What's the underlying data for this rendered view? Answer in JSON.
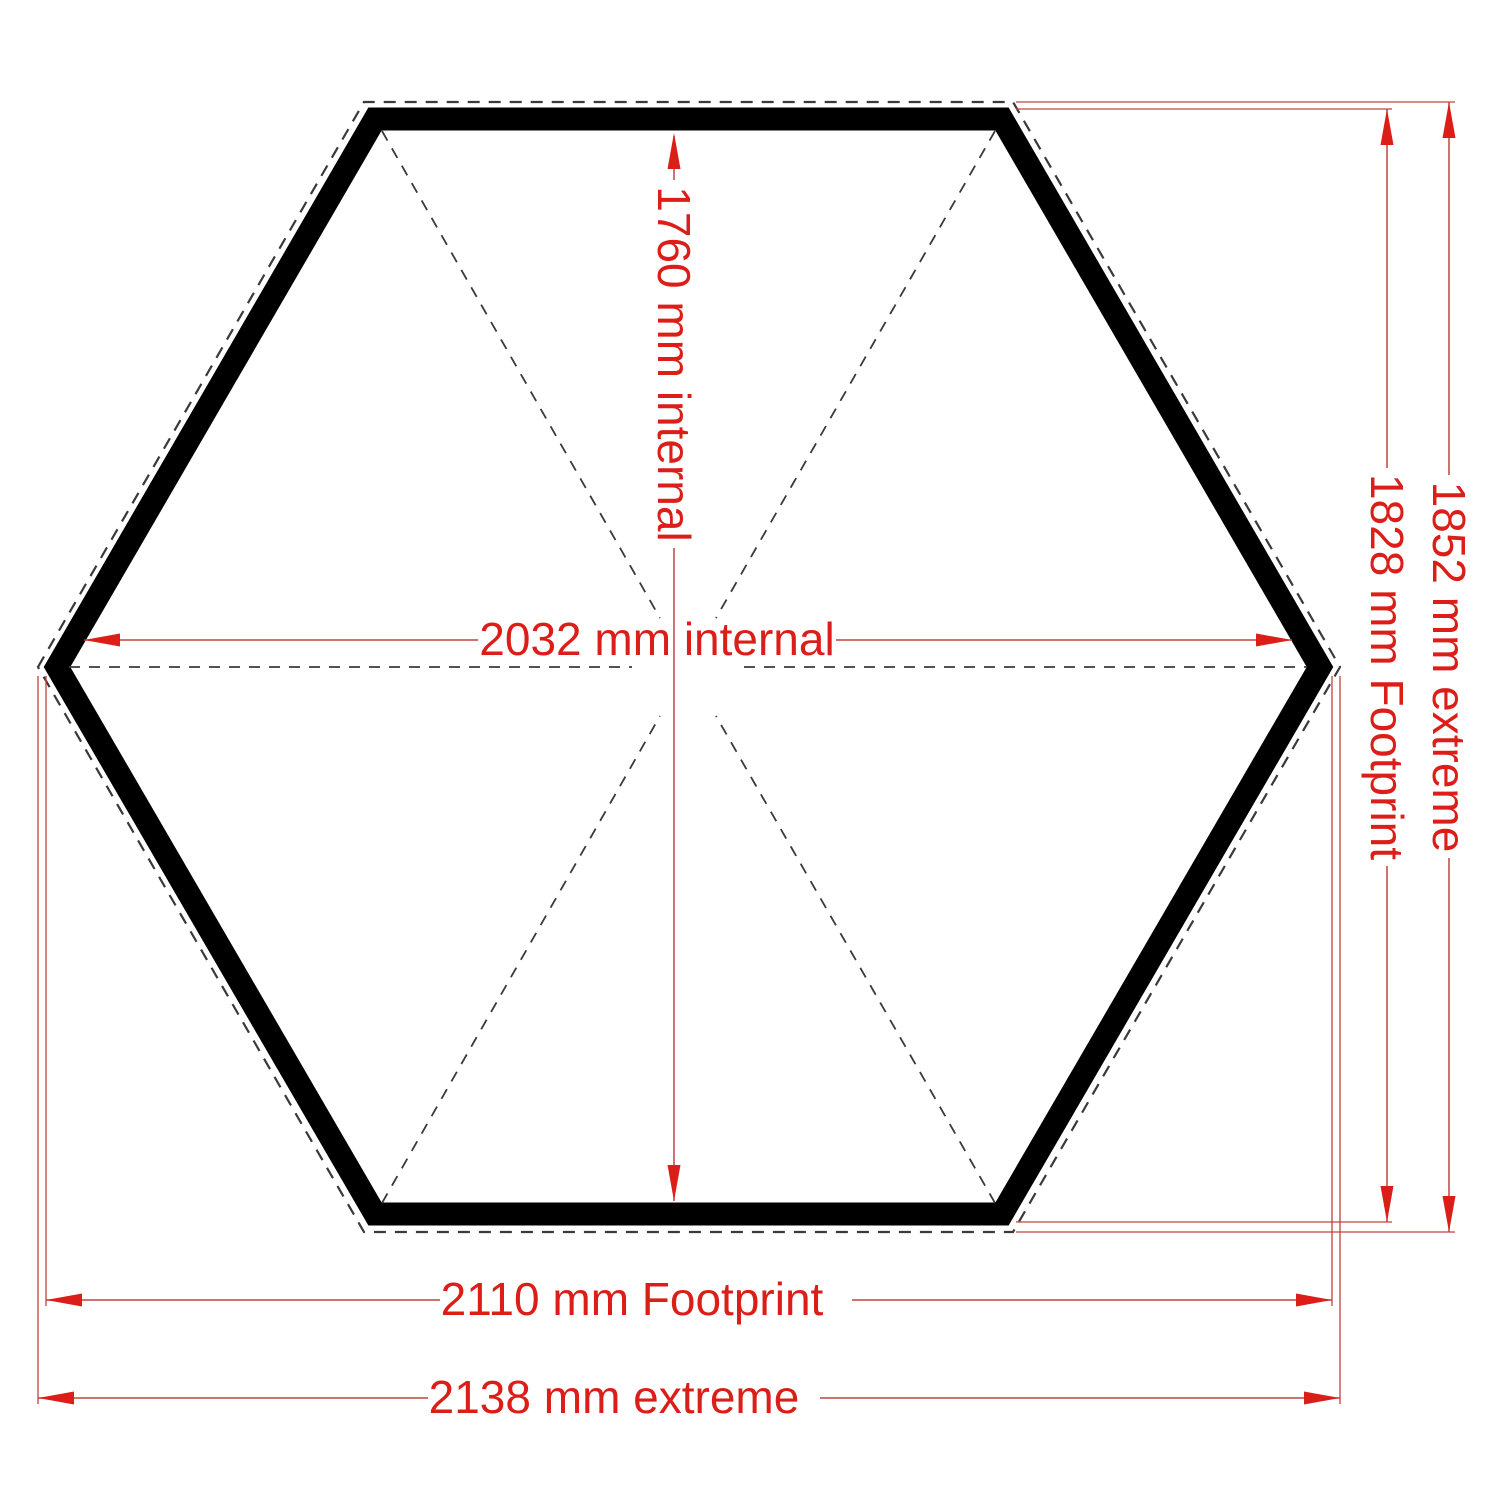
{
  "drawing": {
    "type": "hexagonal floor plan",
    "dimensions": {
      "internal_depth": {
        "label": "1760 mm internal",
        "value": 1760,
        "unit": "mm",
        "qualifier": "internal"
      },
      "internal_width": {
        "label": "2032 mm internal",
        "value": 2032,
        "unit": "mm",
        "qualifier": "internal"
      },
      "footprint_height": {
        "label": "1828 mm Footprint",
        "value": 1828,
        "unit": "mm",
        "qualifier": "Footprint"
      },
      "extreme_height": {
        "label": "1852 mm extreme",
        "value": 1852,
        "unit": "mm",
        "qualifier": "extreme"
      },
      "footprint_width": {
        "label": "2110 mm Footprint",
        "value": 2110,
        "unit": "mm",
        "qualifier": "Footprint"
      },
      "extreme_width": {
        "label": "2138 mm extreme",
        "value": 2138,
        "unit": "mm",
        "qualifier": "extreme"
      }
    },
    "colors": {
      "background": "#ffffff",
      "wall": "#000000",
      "hidden_lines": "#3a3a3a",
      "dimension_accent": "#dc1e19",
      "dimension_line": "#c0453f"
    }
  }
}
